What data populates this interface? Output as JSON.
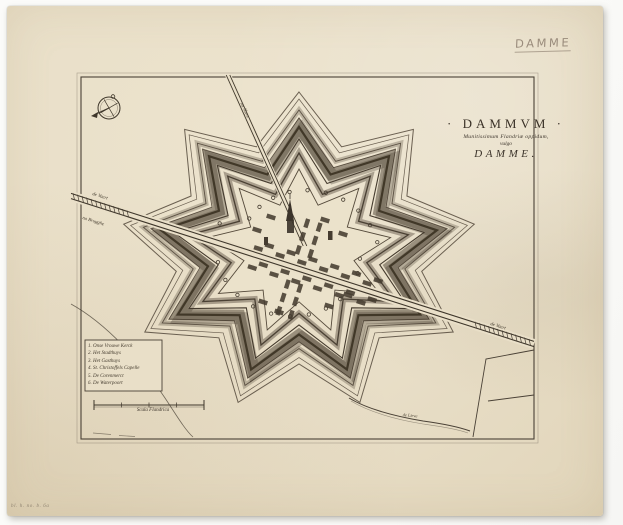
{
  "title": {
    "main": "· DAMMVM ·",
    "subtitle": "Munitissimum Flandriæ oppidum,",
    "vulgo": "vulgo",
    "name": "DAMME."
  },
  "handwritten_note": "DAMME",
  "inventory_mark": "bl. h. no. b. 6a",
  "map_labels": {
    "canal_left_name": "de Vaert",
    "canal_left_dest": "na Brugghe",
    "road_top": "na Sluys",
    "canal_right": "de Vaert",
    "stream": "de Lieve",
    "scale_caption": "Scala Flandrica"
  },
  "legend": {
    "items": [
      "1. Onse Vrouwe Kerck",
      "2. Het Stadthuys",
      "3. Het Gasthuys",
      "4. St. Christoffels Capelle",
      "5. De Corenmerct",
      "6. De Waterpoort"
    ]
  },
  "colors": {
    "paper": "#e9dfc8",
    "ink": "#3b332a",
    "pencil": "#9a8c7c",
    "background": "#fbfbf9"
  }
}
